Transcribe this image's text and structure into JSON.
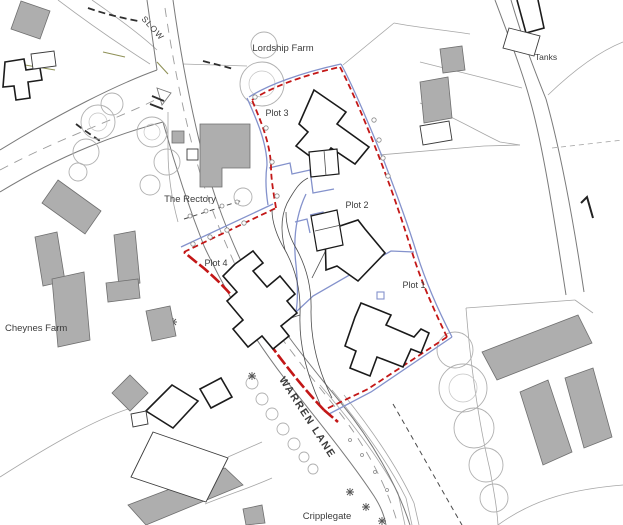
{
  "map": {
    "type": "site-plan",
    "labels": {
      "slow": "SLOW",
      "lordship_farm": "Lordship Farm",
      "tanks": "Tanks",
      "plot1": "Plot 1",
      "plot2": "Plot 2",
      "plot3": "Plot 3",
      "plot4": "Plot 4",
      "the_rectory": "The Rectory",
      "cheynes_farm": "Cheynes Farm",
      "warren_lane": "WARREN LANE",
      "cripplegate": "Cripplegate"
    },
    "colors": {
      "site_boundary_red": "#c31717",
      "ownership_line_blue": "#8492cc",
      "existing_building_gray": "#aeaeae",
      "road_marking_olive": "#8f9157",
      "drawing_line_dark": "#2e2e2e",
      "drawing_line_light": "#a6a6a6"
    }
  }
}
